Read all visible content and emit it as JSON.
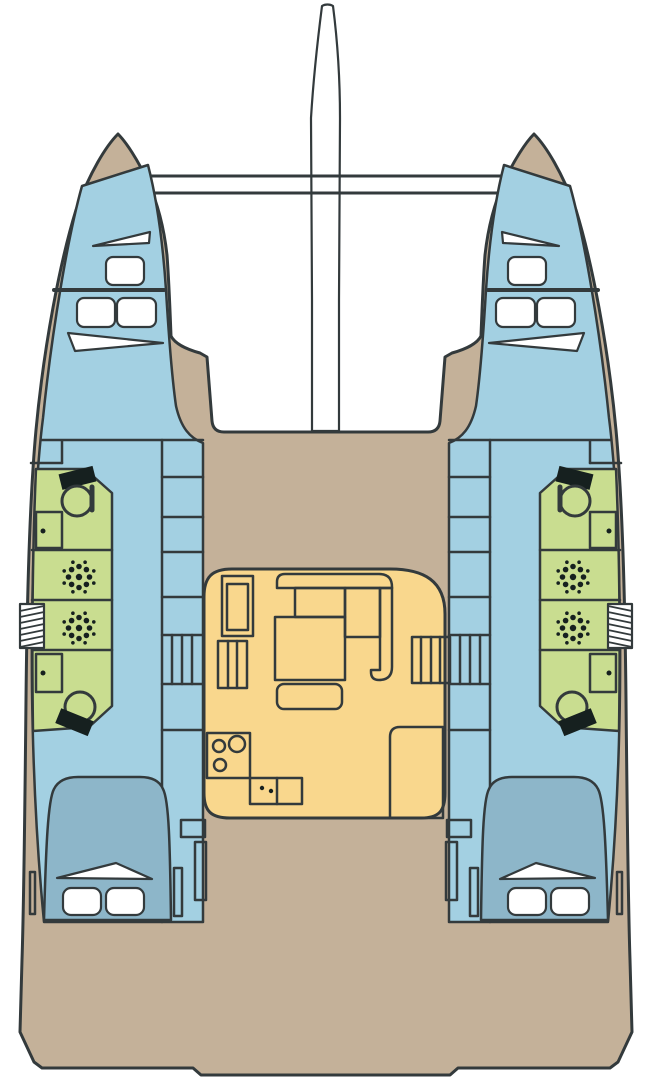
{
  "diagram": {
    "title": "Catamaran interior deck plan",
    "type": "floor-plan",
    "view": "top-down",
    "colors": {
      "background": "#ffffff",
      "outline": "#333a3c",
      "deck": "#c4b199",
      "cabin": "#a3d0e2",
      "bed": "#8db6c9",
      "head": "#c9dd90",
      "salon": "#f9d78d",
      "white": "#ffffff",
      "fixture": "#16201f",
      "border": "#c9c9c9"
    },
    "regions": {
      "mast": "mast and boom",
      "crossbeams": "forward crossbeams",
      "trampoline_gap": "open area between bows",
      "foredeck": "foredeck",
      "port_bow_cabin": "port forward cabin with hatches",
      "starboard_bow_cabin": "starboard forward cabin with hatches",
      "port_heads": "port heads with toilets, sinks and shower drains",
      "starboard_heads": "starboard heads with toilets, sinks and shower drains",
      "port_aft_cabin": "port aft cabin with double berth",
      "starboard_aft_cabin": "starboard aft cabin with double berth",
      "salon": "salon with dinette, nav seat, galley stove, sink and fridge",
      "companionway_steps": "steps down to each hull",
      "aft_deck": "aft cockpit deck with swim steps"
    }
  }
}
